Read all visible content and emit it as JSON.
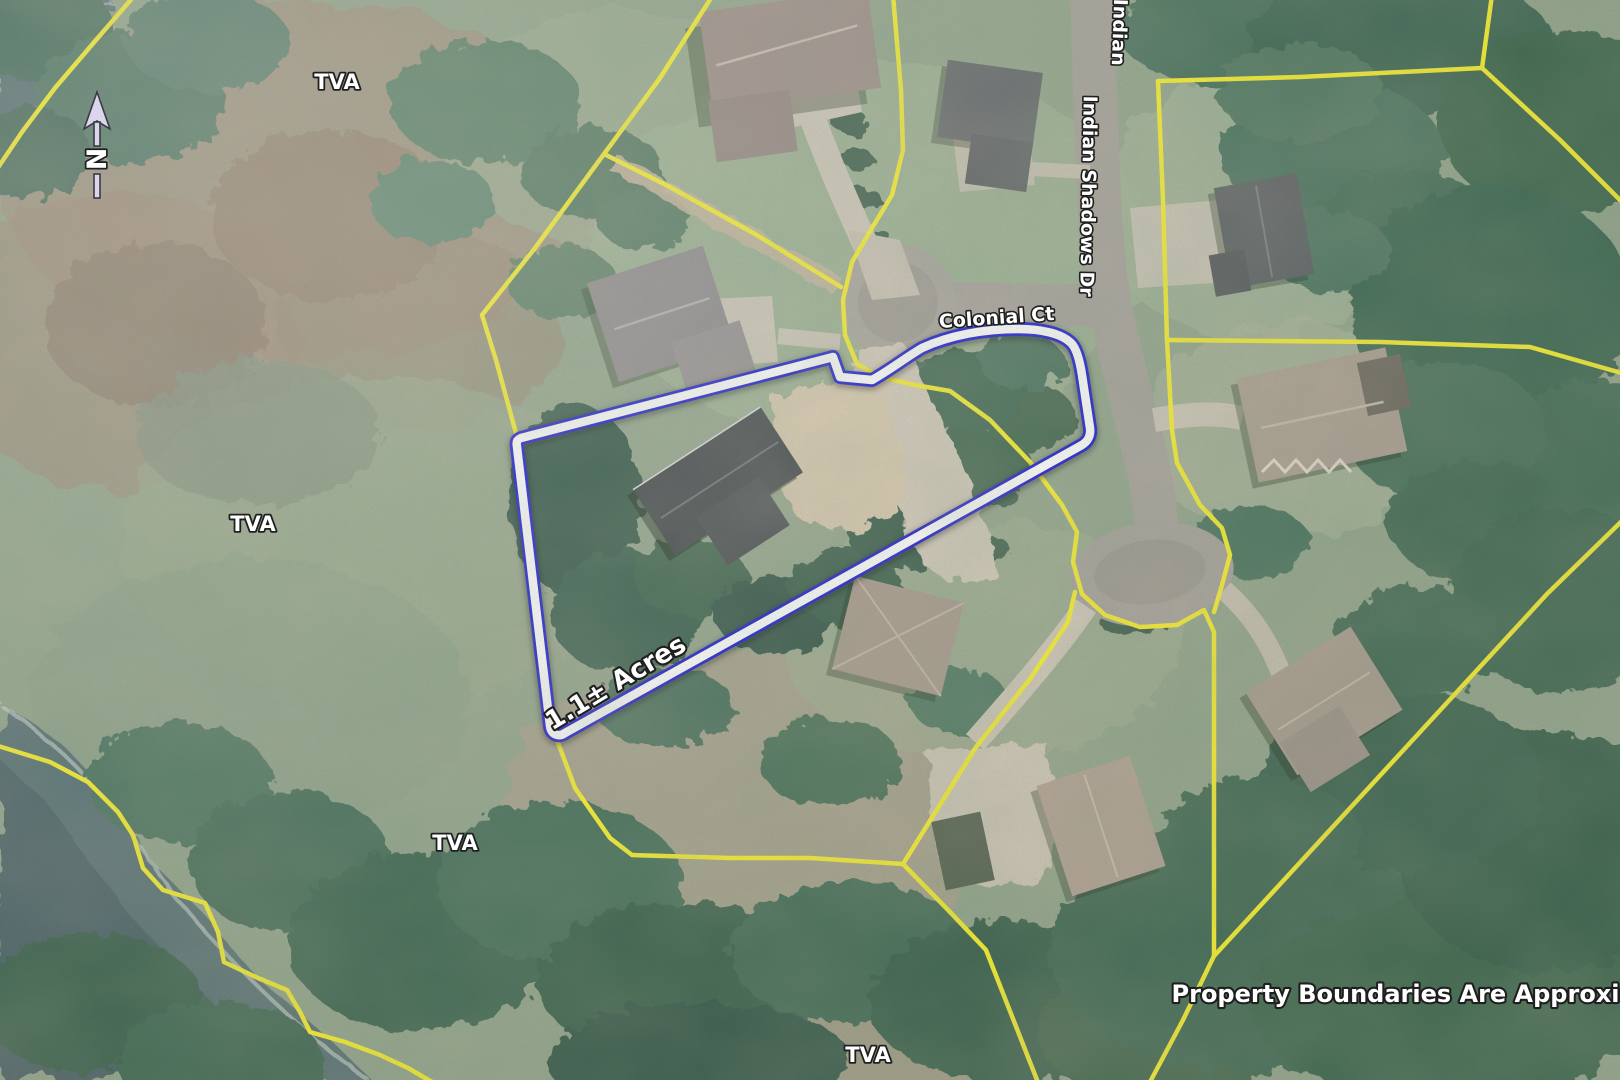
{
  "map": {
    "title": "Aerial parcel map",
    "disclaimer": "Property Boundaries Are Approximate",
    "subject": {
      "area_label": "1.1± Acres"
    },
    "compass": {
      "label": "N"
    },
    "roads": {
      "colonial": "Colonial Ct",
      "indian_shadows": "Indian Shadows Dr",
      "indian_partial": "Indian"
    },
    "tva": {
      "nw": "TVA",
      "west": "TVA",
      "southwest": "TVA",
      "south": "TVA"
    },
    "colors": {
      "parcel_line": "#f7ee2e",
      "subject_blue": "#1c1ccf",
      "subject_white": "#ffffff",
      "water": "#5a7274",
      "road": "#a7a29b",
      "label": "#ffffff",
      "label_outline": "#1f1f1f"
    }
  }
}
